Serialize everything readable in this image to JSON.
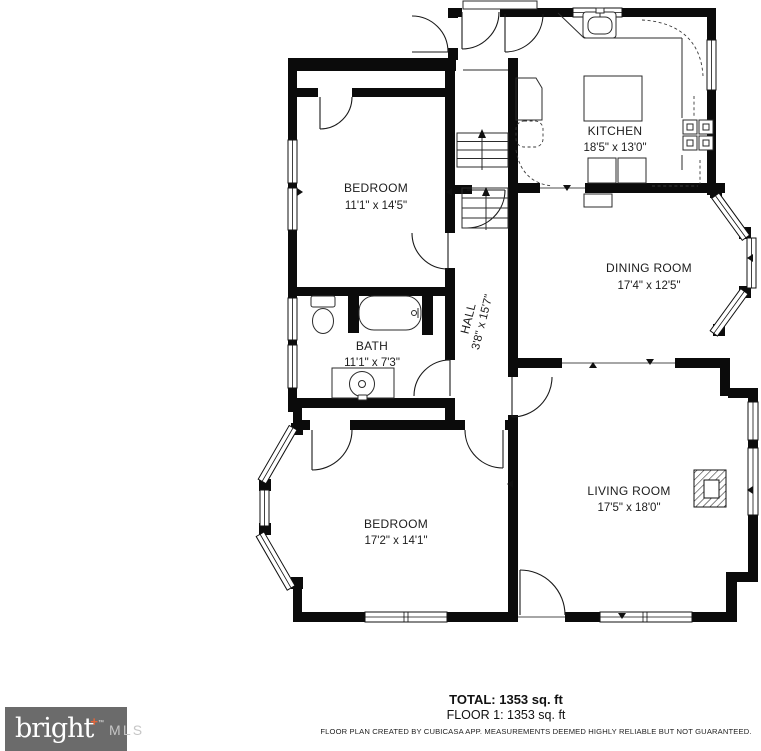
{
  "rooms": [
    {
      "name": "KITCHEN",
      "dims": "18'5\" x 13'0\""
    },
    {
      "name": "BEDROOM",
      "dims": "11'1\" x 14'5\""
    },
    {
      "name": "DINING ROOM",
      "dims": "17'4\" x 12'5\""
    },
    {
      "name": "BATH",
      "dims": "11'1\" x 7'3\""
    },
    {
      "name": "HALL",
      "dims": "3'8\" x 15'7\""
    },
    {
      "name": "BEDROOM",
      "dims": "17'2\" x 14'1\""
    },
    {
      "name": "LIVING ROOM",
      "dims": "17'5\" x 18'0\""
    }
  ],
  "summary": {
    "total": "TOTAL: 1353 sq. ft",
    "floor": "FLOOR 1: 1353 sq. ft",
    "disclaimer": "FLOOR PLAN CREATED BY CUBICASA APP. MEASUREMENTS DEEMED HIGHLY RELIABLE BUT NOT GUARANTEED."
  },
  "logo": {
    "brand": "bright",
    "plus": "+",
    "tm": "™",
    "suffix": "MLS"
  },
  "colors": {
    "wall": "#0b0b0b",
    "logo_bg": "#6b6b6b",
    "logo_plus": "#e0653a",
    "logo_suffix": "#c6c6c6"
  }
}
